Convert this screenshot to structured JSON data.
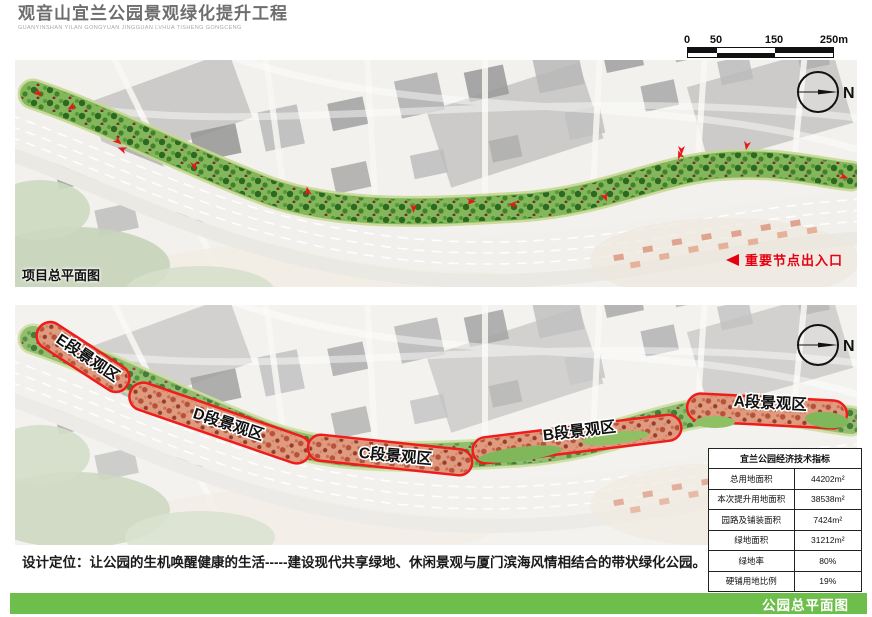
{
  "header": {
    "title": "观音山宜兰公园景观绿化提升工程",
    "subtitle": "GUANYINSHAN  YILAN GONGYUAN JINGGUAN LVHUA TISHENG GONGCENG"
  },
  "scalebar": {
    "labels": [
      "0",
      "50",
      "150",
      "250m"
    ]
  },
  "panel1": {
    "caption": "项目总平面图",
    "legend": "重要节点出入口",
    "compass": "N"
  },
  "panel2": {
    "compass": "N",
    "zones": [
      {
        "label": "E段景观区"
      },
      {
        "label": "D段景观区"
      },
      {
        "label": "C段景观区"
      },
      {
        "label": "B段景观区"
      },
      {
        "label": "A段景观区"
      }
    ]
  },
  "table": {
    "title": "宜兰公园经济技术指标",
    "rows": [
      {
        "label": "总用地面积",
        "value": "44202m²"
      },
      {
        "label": "本次提升用地面积",
        "value": "38538m²"
      },
      {
        "label": "园路及铺装面积",
        "value": "7424m²"
      },
      {
        "label": "绿地面积",
        "value": "31212m²"
      },
      {
        "label": "绿地率",
        "value": "80%"
      },
      {
        "label": "硬铺用地比例",
        "value": "19%"
      }
    ]
  },
  "design_text": "设计定位：让公园的生机唤醒健康的生活-----建设现代共享绿地、休闲景观与厦门滨海风情相结合的带状绿化公园。",
  "footer": {
    "label": "公园总平面图"
  },
  "colors": {
    "accent_green": "#6dbe4a",
    "zone_red": "#ef1c1c",
    "legend_red": "#e60012"
  }
}
